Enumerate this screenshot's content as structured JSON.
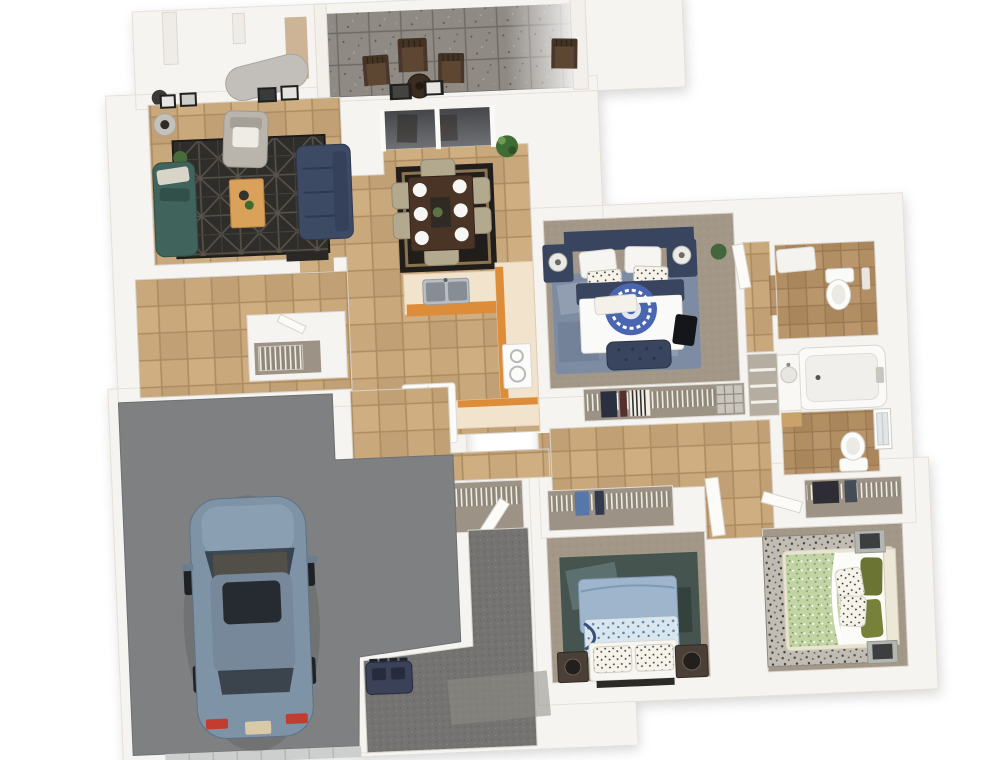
{
  "scene": {
    "kind": "3d-floor-plan-render",
    "view": "top-down dollhouse view, slightly rotated",
    "description": "Single-story 3-bedroom 2-bath home with open living/dining/kitchen, rear patio, den and attached single-car garage"
  },
  "rooms": [
    {
      "name": "patio",
      "floor": "gray speckled outdoor tile",
      "contents": [
        "wood patio chairs",
        "round side table"
      ]
    },
    {
      "name": "entry-porch",
      "floor": "white",
      "contents": [
        "duct",
        "wall stubs"
      ]
    },
    {
      "name": "living-room",
      "floor": "tan tile",
      "contents": [
        "navy sofa",
        "teal chaise",
        "gray armchair",
        "wood coffee table",
        "black geometric rug",
        "wall art frames",
        "floor lamp",
        "media console",
        "plant"
      ]
    },
    {
      "name": "dining-room",
      "floor": "tan tile",
      "contents": [
        "dark wood table",
        "six beige chairs",
        "white place settings",
        "black bordered rug",
        "sliding glass door to patio",
        "potted plant"
      ]
    },
    {
      "name": "kitchen",
      "floor": "tan tile",
      "contents": [
        "island with double sink",
        "L-counter with stove",
        "refrigerator",
        "orange cabinets",
        "cream countertops"
      ]
    },
    {
      "name": "foyer",
      "floor": "tan tile",
      "contents": [
        "coat closet with wire basket",
        "door"
      ]
    },
    {
      "name": "master-bedroom",
      "floor": "taupe carpet",
      "contents": [
        "bed with navy headboard",
        "white duvet with blue medallion",
        "navy tufted bench",
        "two nightstands with lamps",
        "blue-gray rug",
        "plant"
      ]
    },
    {
      "name": "master-closet",
      "floor": "carpet",
      "contents": [
        "wire shelving",
        "hanging clothes",
        "wire basket unit"
      ]
    },
    {
      "name": "master-bathroom",
      "floor": "brown tile",
      "contents": [
        "toilet",
        "white bath rug"
      ]
    },
    {
      "name": "hall-bathroom",
      "floor": "brown tile",
      "contents": [
        "bathtub",
        "vanity sink",
        "toilet",
        "window",
        "wood mat"
      ]
    },
    {
      "name": "linen-closet",
      "floor": "white",
      "contents": [
        "shelves"
      ]
    },
    {
      "name": "hallway",
      "floor": "tan tile",
      "contents": [
        "double wire-shelf closet",
        "doors to bedrooms"
      ]
    },
    {
      "name": "bedroom-2",
      "floor": "taupe carpet",
      "contents": [
        "bed with light blue bedding",
        "two speaker nightstands",
        "dark green-blue rug",
        "closet with wire shelf"
      ]
    },
    {
      "name": "bedroom-3",
      "floor": "taupe carpet",
      "contents": [
        "cream bed, green and white duvet",
        "olive pillows",
        "polka-dot pillows",
        "two gray nightstands",
        "gray patterned rug",
        "closet with wire shelf"
      ]
    },
    {
      "name": "den",
      "floor": "dark gray carpet",
      "contents": [
        "navy storage chest",
        "light floor patch"
      ]
    },
    {
      "name": "garage",
      "floor": "gray concrete",
      "contents": [
        "steel-blue sedan",
        "garage door"
      ]
    }
  ],
  "palette": {
    "background": "#ffffff",
    "walls": "#f6f4f1",
    "wall_edge": "#ddd7cf",
    "tile_tan": "#c9a87c",
    "tile_grout": "#ae8c61",
    "tile_bath": "#b28e63",
    "patio_tile": "#8f8a84",
    "carpet_taupe": "#a39888",
    "carpet_den": "#757371",
    "garage_floor": "#7e8081",
    "sofa_navy": "#3d4a63",
    "chaise_teal": "#40635c",
    "cabinet_orange": "#dd8c3a",
    "counter_cream": "#f2e3cc",
    "bed2_blue": "#9fb5cc",
    "olive_green": "#6b7432",
    "medallion_blue": "#4a66b0",
    "car_body": "#7f93a6",
    "taillight_red": "#c43b30",
    "wood_dark": "#4a3426",
    "rug_black": "#2f2d2a"
  }
}
